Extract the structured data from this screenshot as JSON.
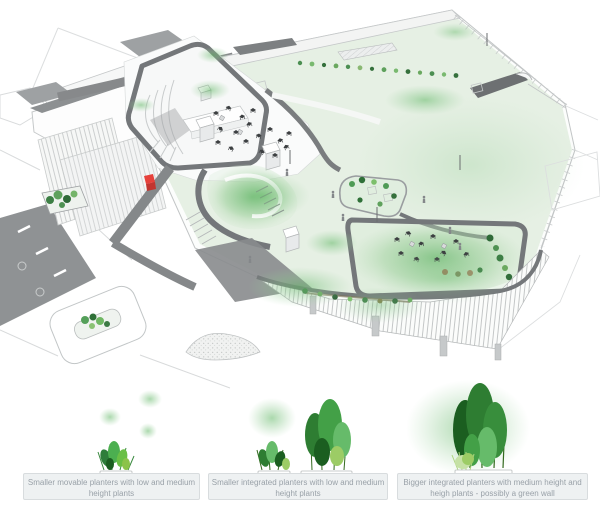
{
  "legend": {
    "items": [
      {
        "id": "movable-planters",
        "caption": "Smaller movable planters with low and medium height plants"
      },
      {
        "id": "smaller-integrated-planters",
        "caption": "Smaller integrated planters with low and medium height plants"
      },
      {
        "id": "bigger-integrated-planters",
        "caption": "Bigger integrated planters with medium height and heigh plants - possibly a green wall"
      }
    ]
  },
  "colors": {
    "background": "#ffffff",
    "lawn_green": "#e6f0e4",
    "glow_green": "#7cc47f",
    "terrace_green": "#8cc88c",
    "path_dark_gray": "#76797b",
    "outline_gray": "#c2c5c6",
    "accent_red": "#e6413b",
    "plant_dark_green": "#2e7d32",
    "plant_light_green": "#8bc34a",
    "caption_bg": "#eef1f2",
    "caption_border": "#d8dcde",
    "caption_text": "#99a1a8"
  }
}
